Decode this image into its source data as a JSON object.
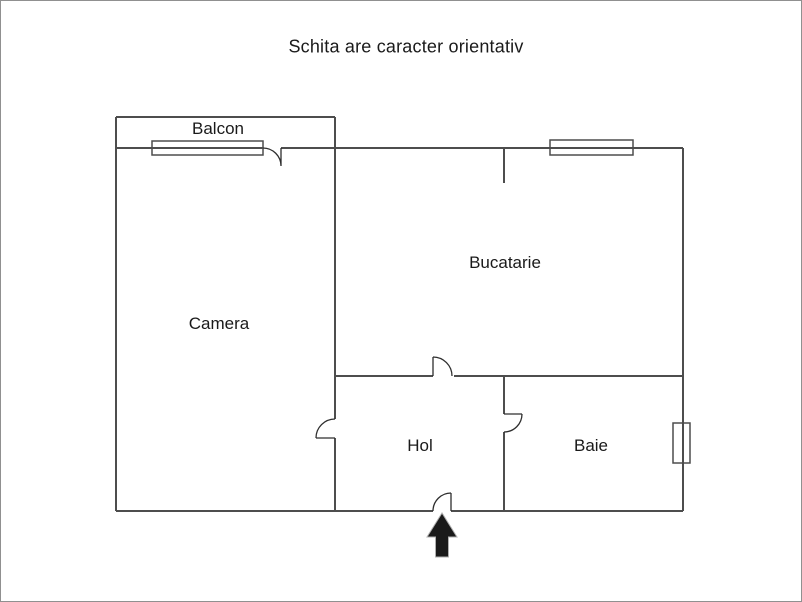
{
  "title": "Schita are caracter orientativ",
  "rooms": {
    "balcon": {
      "label": "Balcon"
    },
    "camera": {
      "label": "Camera"
    },
    "bucatarie": {
      "label": "Bucatarie"
    },
    "hol": {
      "label": "Hol"
    },
    "baie": {
      "label": "Baie"
    }
  },
  "icons": {
    "entrance_arrow": "up-arrow"
  },
  "colors": {
    "wall": "#4d4d4d",
    "door": "#2e2e2e",
    "arrow_fill": "#1a1a1a",
    "arrow_outline": "#b0b0b0",
    "page_border": "#909090",
    "text": "#1a1a1a",
    "background": "#ffffff"
  }
}
